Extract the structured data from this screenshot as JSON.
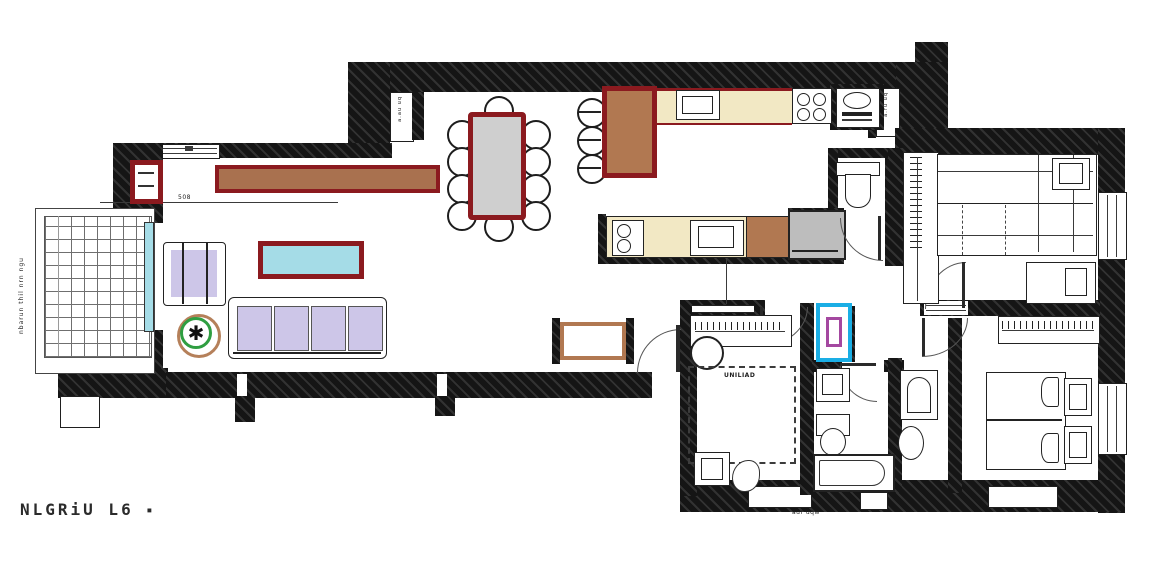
{
  "title": {
    "text": "NLGRiU L6",
    "mark": "▪"
  },
  "labels": {
    "bedroom_note": "UNILIAD",
    "exterior_bottom": "aur uqw",
    "balcony_side_vertical": "nbarun thil nrn ngu",
    "wall_niche_left_vertical": "a.au uq",
    "wall_niche_right_vertical": "a.ru uq",
    "dim_top_left": "508"
  },
  "icons": {
    "plant": "✱"
  },
  "colors": {
    "wall": "#161616",
    "accent_maroon": "#8b1a1f",
    "wood_brown": "#b17851",
    "sideboard_brown": "#a9714f",
    "counter_cream": "#f2e8c4",
    "upholstery_lavender": "#cdc6e8",
    "glass_cyan": "#a5dce7",
    "table_gray": "#cfcfcf",
    "appliance_gray": "#bdbdbd",
    "highlight_cyan": "#1aaee5",
    "highlight_purple": "#a448a0",
    "plant_green": "#2f9e41",
    "plant_pot_brown": "#b5805a"
  }
}
